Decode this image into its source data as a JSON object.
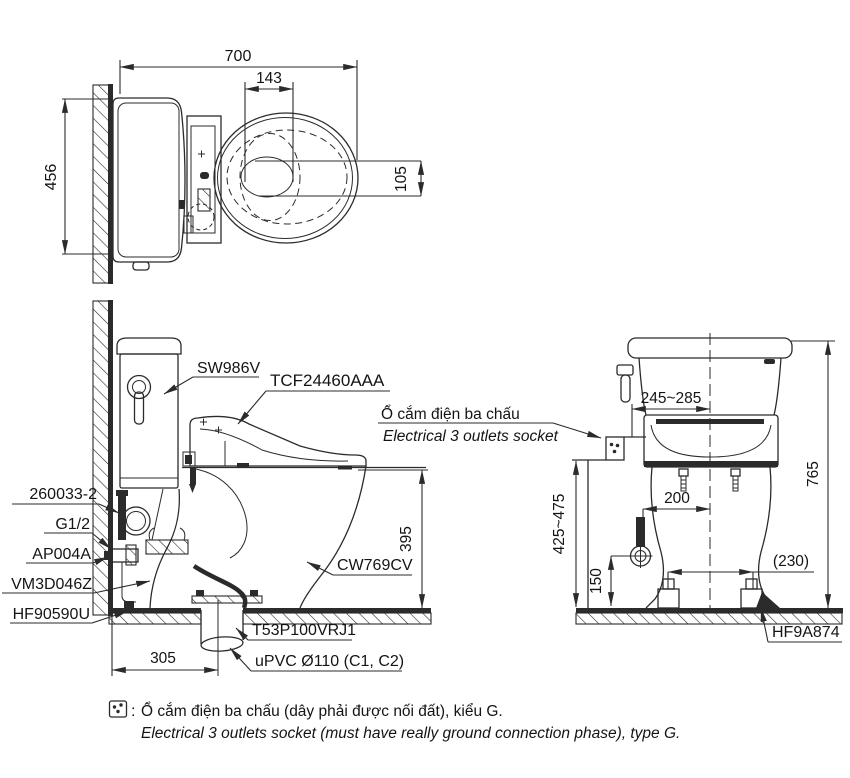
{
  "colors": {
    "line": "#2b2b2b",
    "text": "#141414",
    "background": "#ffffff"
  },
  "top_view": {
    "dim_total_width": "700",
    "dim_seat_center": "143",
    "dim_tank_width": "456",
    "dim_center_offset": "105"
  },
  "side_view": {
    "label_cistern": "SW986V",
    "label_seat_unit": "TCF24460AAA",
    "socket_label_vi": "Ổ cắm điện ba chấu",
    "socket_label_en": "Electrical 3 outlets socket",
    "label_supply_hose": "260033-2",
    "label_thread": "G1/2",
    "label_stop_valve": "AP004A",
    "label_connector": "VM3D046Z",
    "label_fixing_kit": "HF90590U",
    "label_bowl": "CW769CV",
    "label_flange": "T53P100VRJ1",
    "label_drain_pipe": "uPVC Ø110 (C1, C2)",
    "dim_rim_height": "395",
    "dim_rough_in": "305"
  },
  "front_view": {
    "dim_socket_offset": "245~285",
    "dim_total_height": "765",
    "dim_socket_height": "425~475",
    "dim_supply_to_center": "200",
    "dim_foot_spacing": "(230)",
    "dim_valve_height": "150",
    "label_foot_cap": "HF9A874"
  },
  "legend": {
    "separator": ":",
    "socket_icon": "three-dot-socket-icon",
    "note_vi": "Ổ cắm điện ba chấu (dây phải được nối đất), kiểu G.",
    "note_en": "Electrical 3 outlets socket (must have really ground connection phase), type G."
  }
}
